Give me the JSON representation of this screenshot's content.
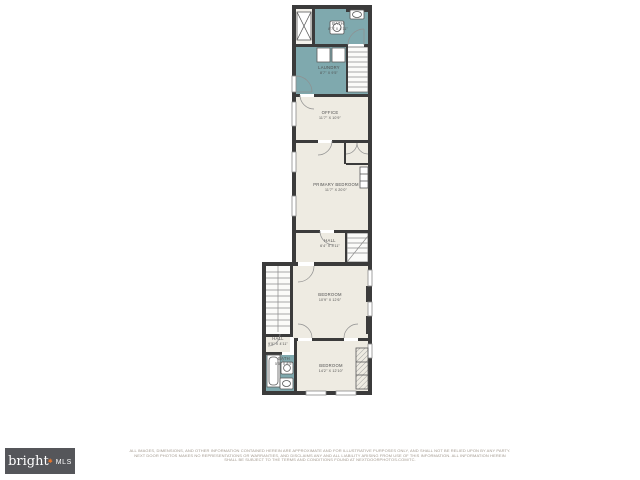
{
  "branding": {
    "logo_word": "bright",
    "logo_star": "✱",
    "logo_suffix": "MLS",
    "logo_bg_color": "#55565a",
    "logo_text_color": "#ffffff",
    "logo_star_color": "#e8762d"
  },
  "colors": {
    "wall": "#3b3b3b",
    "floor": "#eeebe2",
    "wet_room": "#7fa9ae",
    "label_text": "#4f4f4f",
    "disclaimer_text": "#a2988d"
  },
  "rooms": {
    "bath_upper": {
      "name": "BATH",
      "dims": "8'7\" X 4'11\""
    },
    "laundry": {
      "name": "LAUNDRY",
      "dims": "8'7\" X 9'5\""
    },
    "office": {
      "name": "OFFICE",
      "dims": "11'7\" X 10'9\""
    },
    "primary": {
      "name": "PRIMARY BEDROOM",
      "dims": "11'7\" X 20'0\""
    },
    "hall_upper": {
      "name": "HALL",
      "dims": "6'4\" X 3'11\""
    },
    "bedroom_middle": {
      "name": "BEDROOM",
      "dims": "10'9\" X 12'6\""
    },
    "hall_lower": {
      "name": "HALL",
      "dims": "9'5\" X 4'11\""
    },
    "bath_lower": {
      "name": "BATH",
      "dims": "5'5\" X 8'5\""
    },
    "bedroom_lower": {
      "name": "BEDROOM",
      "dims": "14'2\" X 12'10\""
    }
  },
  "disclaimer": {
    "line1": "ALL IMAGES, DIMENSIONS, AND OTHER INFORMATION CONTAINED HEREIN ARE APPROXIMATE AND FOR ILLUSTRATIVE PURPOSES ONLY, AND SHALL NOT BE RELIED UPON BY ANY PARTY.",
    "line2": "NEXT DOOR PHOTOS MAKES NO REPRESENTATIONS OR WARRANTIES, AND DISCLAIMS ANY AND ALL LIABILITY ARISING FROM USE OF THIS INFORMATION. ALL INFORMATION HEREIN",
    "line3": "SHALL BE SUBJECT TO THE TERMS AND CONDITIONS FOUND AT NEXTDOORPHOTOS.COM/TC."
  }
}
